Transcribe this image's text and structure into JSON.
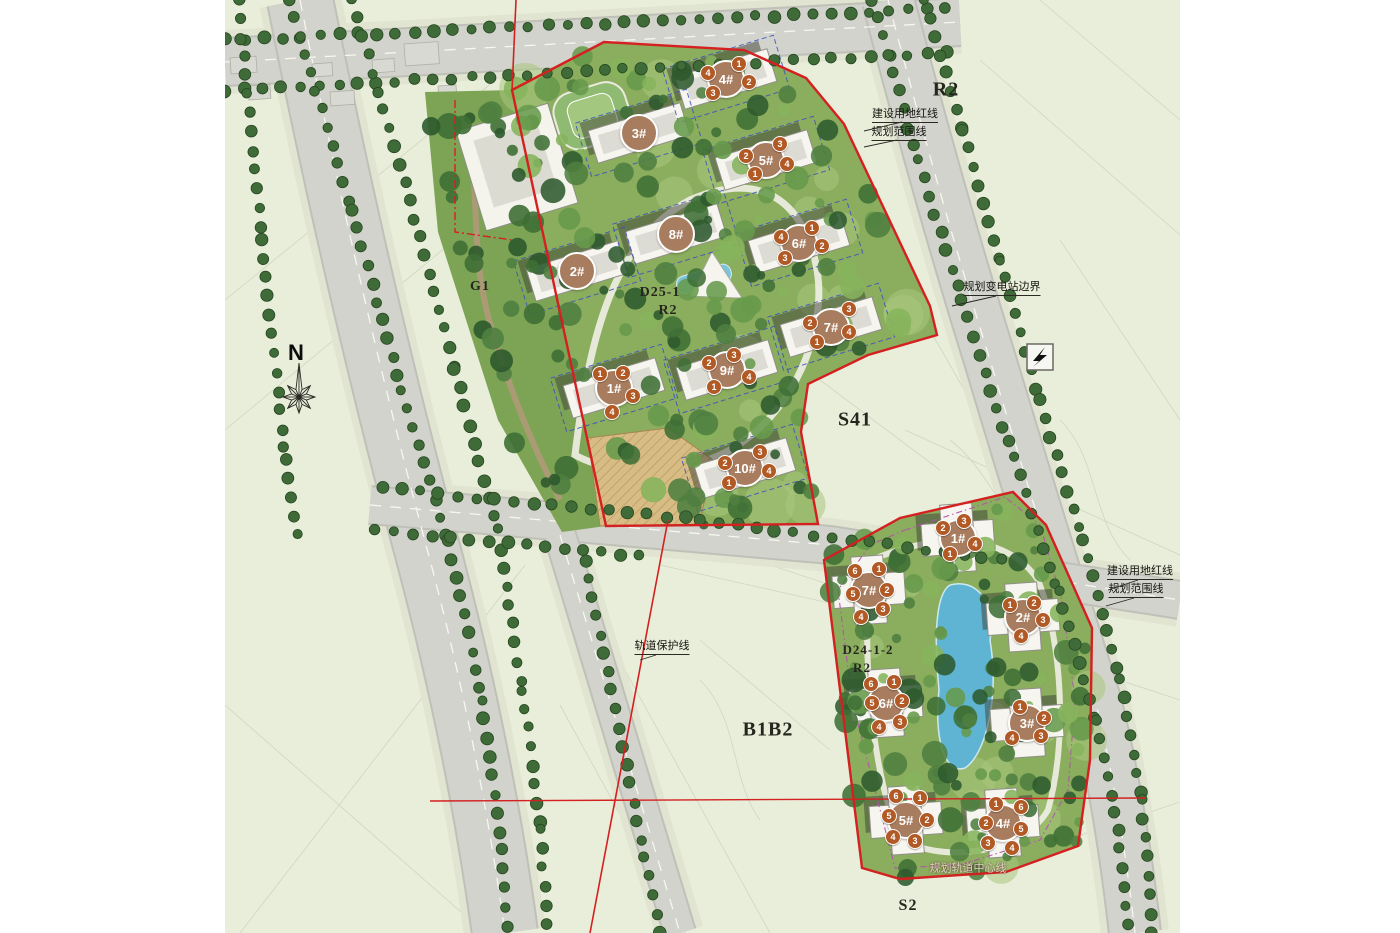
{
  "page": {
    "background": "#ffffff"
  },
  "map": {
    "colors": {
      "background": "#e9eedb",
      "road": "#d2d3cc",
      "parcel_green": "#8aad5e",
      "boundary_red": "#d42020",
      "unit_boundary_blue": "#3b4fc0",
      "violet_dash": "#b44fb0",
      "pool_blue": "#5fb4d4",
      "big_marker": "#a87c5e",
      "small_marker": "#b25a26",
      "street_tree": "#3e6b38"
    },
    "compass": {
      "label": "N",
      "x": 296,
      "y": 353
    },
    "zones": [
      {
        "id": "zone-r2-north",
        "text": "R2",
        "x": 946,
        "y": 90,
        "size": 20
      },
      {
        "id": "zone-s41",
        "text": "S41",
        "x": 855,
        "y": 420,
        "size": 20
      },
      {
        "id": "zone-b1b2",
        "text": "B1B2",
        "x": 768,
        "y": 730,
        "size": 20
      },
      {
        "id": "zone-s2",
        "text": "S2",
        "x": 908,
        "y": 906,
        "size": 16
      },
      {
        "id": "zone-g1",
        "text": "G1",
        "x": 480,
        "y": 287,
        "size": 14
      },
      {
        "id": "parcel-upper-code",
        "text": "D25-1",
        "x": 660,
        "y": 293,
        "size": 14
      },
      {
        "id": "parcel-upper-zone",
        "text": "R2",
        "x": 668,
        "y": 311,
        "size": 14
      },
      {
        "id": "parcel-lower-code",
        "text": "D24-1-2",
        "x": 868,
        "y": 650,
        "size": 13
      },
      {
        "id": "parcel-lower-zone",
        "text": "R2",
        "x": 862,
        "y": 668,
        "size": 13
      }
    ],
    "annotations": [
      {
        "id": "ann-redline-top",
        "text": "建设用地红线",
        "x": 905,
        "y": 116,
        "underline": true
      },
      {
        "id": "ann-scope-top",
        "text": "规划范围线",
        "x": 899,
        "y": 134,
        "underline": true
      },
      {
        "id": "ann-substation",
        "text": "规划变电站边界",
        "x": 1002,
        "y": 289,
        "underline": true
      },
      {
        "id": "ann-rail-protect",
        "text": "轨道保护线",
        "x": 662,
        "y": 648,
        "underline": true
      },
      {
        "id": "ann-redline-right",
        "text": "建设用地红线",
        "x": 1140,
        "y": 573,
        "underline": true
      },
      {
        "id": "ann-scope-right",
        "text": "规划范围线",
        "x": 1136,
        "y": 591,
        "underline": true
      },
      {
        "id": "ann-rail-center",
        "text": "规划轨道中心线",
        "x": 968,
        "y": 869,
        "light": true
      }
    ],
    "parcels": {
      "upper": {
        "code": "D25-1",
        "zone": "R2",
        "buildings": [
          {
            "label": "1#",
            "x": 614,
            "y": 388,
            "units": [
              {
                "n": "1",
                "x": 600,
                "y": 374
              },
              {
                "n": "2",
                "x": 623,
                "y": 373
              },
              {
                "n": "3",
                "x": 633,
                "y": 396
              },
              {
                "n": "4",
                "x": 612,
                "y": 412
              }
            ]
          },
          {
            "label": "2#",
            "x": 577,
            "y": 271,
            "units": []
          },
          {
            "label": "3#",
            "x": 639,
            "y": 133,
            "units": []
          },
          {
            "label": "4#",
            "x": 726,
            "y": 79,
            "units": [
              {
                "n": "1",
                "x": 739,
                "y": 64
              },
              {
                "n": "4",
                "x": 708,
                "y": 73
              },
              {
                "n": "2",
                "x": 749,
                "y": 82
              },
              {
                "n": "3",
                "x": 713,
                "y": 93
              }
            ]
          },
          {
            "label": "5#",
            "x": 766,
            "y": 160,
            "units": [
              {
                "n": "3",
                "x": 780,
                "y": 144
              },
              {
                "n": "2",
                "x": 746,
                "y": 156
              },
              {
                "n": "4",
                "x": 787,
                "y": 164
              },
              {
                "n": "1",
                "x": 755,
                "y": 174
              }
            ]
          },
          {
            "label": "6#",
            "x": 799,
            "y": 243,
            "units": [
              {
                "n": "1",
                "x": 812,
                "y": 228
              },
              {
                "n": "4",
                "x": 781,
                "y": 237
              },
              {
                "n": "2",
                "x": 822,
                "y": 246
              },
              {
                "n": "3",
                "x": 785,
                "y": 258
              }
            ]
          },
          {
            "label": "7#",
            "x": 831,
            "y": 327,
            "units": [
              {
                "n": "3",
                "x": 849,
                "y": 309
              },
              {
                "n": "2",
                "x": 810,
                "y": 323
              },
              {
                "n": "4",
                "x": 849,
                "y": 332
              },
              {
                "n": "1",
                "x": 817,
                "y": 342
              }
            ]
          },
          {
            "label": "8#",
            "x": 676,
            "y": 234,
            "units": []
          },
          {
            "label": "9#",
            "x": 727,
            "y": 370,
            "units": [
              {
                "n": "3",
                "x": 734,
                "y": 355
              },
              {
                "n": "2",
                "x": 709,
                "y": 363
              },
              {
                "n": "4",
                "x": 749,
                "y": 377
              },
              {
                "n": "1",
                "x": 714,
                "y": 387
              }
            ]
          },
          {
            "label": "10#",
            "x": 745,
            "y": 468,
            "units": [
              {
                "n": "3",
                "x": 760,
                "y": 452
              },
              {
                "n": "2",
                "x": 725,
                "y": 463
              },
              {
                "n": "4",
                "x": 769,
                "y": 471
              },
              {
                "n": "1",
                "x": 729,
                "y": 483
              }
            ]
          }
        ]
      },
      "lower": {
        "code": "D24-1-2",
        "zone": "R2",
        "buildings": [
          {
            "label": "1#",
            "x": 958,
            "y": 538,
            "units": [
              {
                "n": "2",
                "x": 943,
                "y": 528
              },
              {
                "n": "3",
                "x": 964,
                "y": 521
              },
              {
                "n": "4",
                "x": 975,
                "y": 544
              },
              {
                "n": "1",
                "x": 950,
                "y": 554
              }
            ]
          },
          {
            "label": "2#",
            "x": 1023,
            "y": 617,
            "units": [
              {
                "n": "1",
                "x": 1010,
                "y": 605
              },
              {
                "n": "2",
                "x": 1034,
                "y": 603
              },
              {
                "n": "3",
                "x": 1043,
                "y": 620
              },
              {
                "n": "4",
                "x": 1021,
                "y": 636
              }
            ]
          },
          {
            "label": "3#",
            "x": 1027,
            "y": 723,
            "units": [
              {
                "n": "1",
                "x": 1020,
                "y": 707
              },
              {
                "n": "2",
                "x": 1044,
                "y": 718
              },
              {
                "n": "4",
                "x": 1012,
                "y": 738
              },
              {
                "n": "3",
                "x": 1041,
                "y": 736
              }
            ]
          },
          {
            "label": "4#",
            "x": 1003,
            "y": 823,
            "units": [
              {
                "n": "1",
                "x": 996,
                "y": 804
              },
              {
                "n": "6",
                "x": 1021,
                "y": 807
              },
              {
                "n": "2",
                "x": 986,
                "y": 823
              },
              {
                "n": "5",
                "x": 1021,
                "y": 829
              },
              {
                "n": "3",
                "x": 988,
                "y": 843
              },
              {
                "n": "4",
                "x": 1012,
                "y": 848
              }
            ]
          },
          {
            "label": "5#",
            "x": 906,
            "y": 820,
            "units": [
              {
                "n": "6",
                "x": 896,
                "y": 796
              },
              {
                "n": "1",
                "x": 920,
                "y": 798
              },
              {
                "n": "5",
                "x": 889,
                "y": 816
              },
              {
                "n": "2",
                "x": 927,
                "y": 820
              },
              {
                "n": "4",
                "x": 893,
                "y": 837
              },
              {
                "n": "3",
                "x": 915,
                "y": 841
              }
            ]
          },
          {
            "label": "6#",
            "x": 886,
            "y": 703,
            "units": [
              {
                "n": "6",
                "x": 871,
                "y": 684
              },
              {
                "n": "1",
                "x": 894,
                "y": 682
              },
              {
                "n": "5",
                "x": 872,
                "y": 703
              },
              {
                "n": "2",
                "x": 902,
                "y": 701
              },
              {
                "n": "4",
                "x": 879,
                "y": 727
              },
              {
                "n": "3",
                "x": 900,
                "y": 722
              }
            ]
          },
          {
            "label": "7#",
            "x": 869,
            "y": 590,
            "units": [
              {
                "n": "6",
                "x": 855,
                "y": 571
              },
              {
                "n": "1",
                "x": 879,
                "y": 569
              },
              {
                "n": "5",
                "x": 853,
                "y": 594
              },
              {
                "n": "2",
                "x": 887,
                "y": 590
              },
              {
                "n": "4",
                "x": 861,
                "y": 617
              },
              {
                "n": "3",
                "x": 883,
                "y": 609
              }
            ]
          }
        ]
      }
    }
  }
}
